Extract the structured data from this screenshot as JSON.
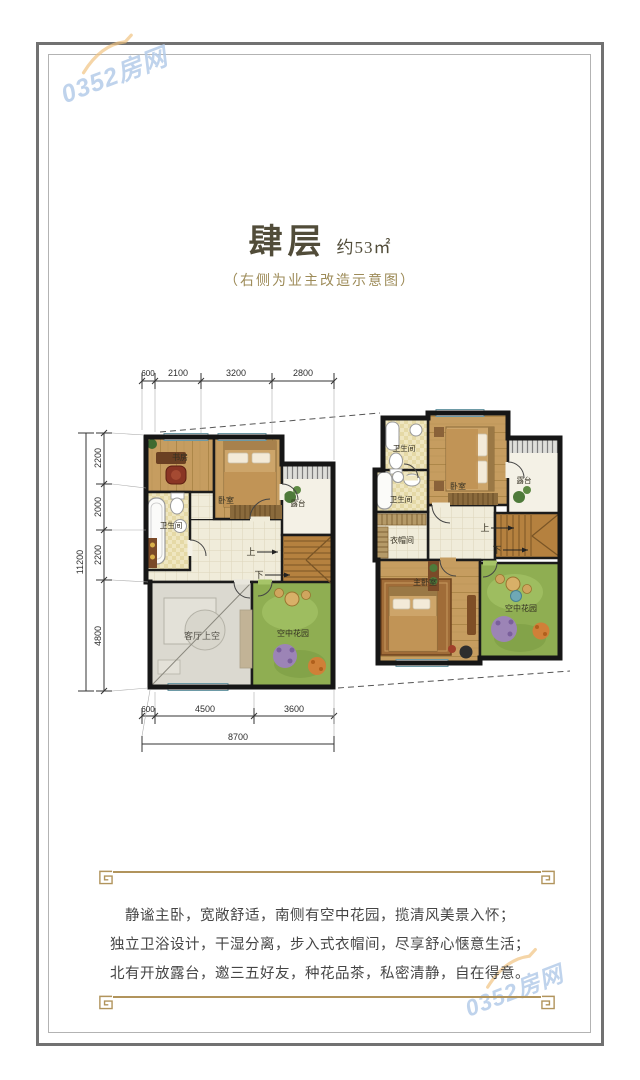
{
  "colors": {
    "accent_gold": "#b1945c",
    "watermark_blue": "#b5cce9",
    "swoosh_orange": "#f0c27e",
    "wall": "#1b1b1b",
    "garden_green": "#8fae52",
    "wood_floor": "#c69d60"
  },
  "watermark": {
    "text": "0352房网"
  },
  "header": {
    "title": "肆层",
    "area_note": "约53㎡",
    "subtitle": "（右侧为业主改造示意图）"
  },
  "dims": {
    "top": [
      "600",
      "2100",
      "3200",
      "2800"
    ],
    "left": [
      "2200",
      "2000",
      "2200",
      "4800"
    ],
    "left_total": "11200",
    "bottom": [
      "600",
      "4500",
      "3600"
    ],
    "bottom_total": "8700"
  },
  "plan_left": {
    "study": "书房",
    "bedroom": "卧室",
    "bath": "卫生间",
    "terrace": "露台",
    "void": "客厅上空",
    "garden": "空中花园",
    "up": "上",
    "down": "下"
  },
  "plan_right": {
    "bath_top": "卫生间",
    "bedroom": "卧室",
    "bath_mid": "卫生间",
    "terrace": "露台",
    "closet": "衣帽间",
    "master": "主卧室",
    "garden": "空中花园",
    "up": "上",
    "down": "下"
  },
  "description": {
    "lines": [
      "静谧主卧，宽敞舒适，南侧有空中花园，揽清风美景入怀；",
      "独立卫浴设计，干湿分离，步入式衣帽间，尽享舒心惬意生活；",
      "北有开放露台，邀三五好友，种花品茶，私密清静，自在得意。"
    ]
  }
}
